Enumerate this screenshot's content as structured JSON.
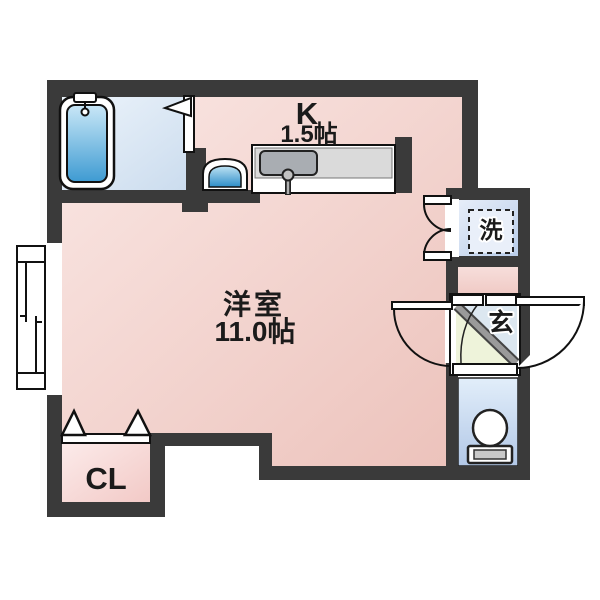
{
  "rooms": {
    "kitchen": {
      "label": "K",
      "size": "1.5帖"
    },
    "living": {
      "label": "洋室",
      "size": "11.0帖"
    },
    "closet": {
      "label": "CL"
    },
    "laundry": {
      "label": "洗"
    },
    "entrance": {
      "label": "玄"
    }
  },
  "fixtures": {
    "bathtub": "bathtub",
    "kitchen_counter": "kitchen-counter-with-sink",
    "wash_basin": "wash-basin",
    "toilet": "toilet",
    "window": "sliding-window",
    "washer_space": "washing-machine-space",
    "closet_doors": "bi-fold-doors",
    "entrance_door": "outward-swing-door"
  },
  "colors": {
    "wall": "#3a3a3a",
    "ink": "#1b1b1b",
    "line": "#111111",
    "pink_light": "#fae7e4",
    "pink_deep": "#ecc2bb",
    "cl_pink_light": "#fcebea",
    "cl_pink_deep": "#f2c9c6",
    "bath_light": "#edf4fb",
    "bath_deep": "#cbdcee",
    "tub_light": "#c9e7f7",
    "tub_deep": "#3e9bd2",
    "laundry_light": "#e7eef9",
    "laundry_deep": "#b9cdea",
    "toilet_light": "#e2eefa",
    "toilet_deep": "#b2c8e7",
    "genkan_floor": "#eef3da",
    "genkan_upper": "#dce7f0",
    "genkan_step": "#979797",
    "counter_gray": "#dadada",
    "sink_gray": "#a9adb2"
  }
}
